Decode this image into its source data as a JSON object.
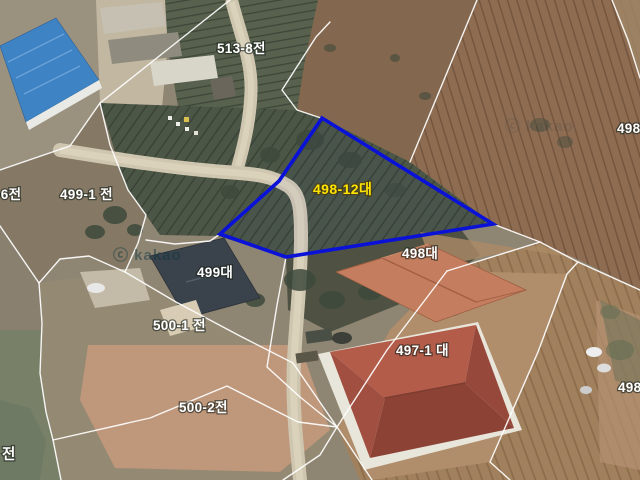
{
  "map": {
    "watermark": "ⓒ kakao",
    "boundary_color": "#ffffff",
    "highlight": {
      "label": "498-12대",
      "label_color": "#ffe400",
      "outline_color": "#0a12d8",
      "points": "322,118 493,224 286,257 220,234 279,181"
    },
    "parcel_labels": [
      {
        "id": "513-8",
        "text": "513-8전"
      },
      {
        "id": "-6",
        "text": "-6전"
      },
      {
        "id": "499-1",
        "text": "499-1 전"
      },
      {
        "id": "499",
        "text": "499대"
      },
      {
        "id": "498",
        "text": "498대"
      },
      {
        "id": "500-1",
        "text": "500-1 전"
      },
      {
        "id": "500-2",
        "text": "500-2전"
      },
      {
        "id": "497-1",
        "text": "497-1 대"
      },
      {
        "id": "498-right-top",
        "text": "498"
      },
      {
        "id": "498-right-bottom",
        "text": "498"
      },
      {
        "id": "jeon-bottom-left",
        "text": "전"
      }
    ]
  }
}
